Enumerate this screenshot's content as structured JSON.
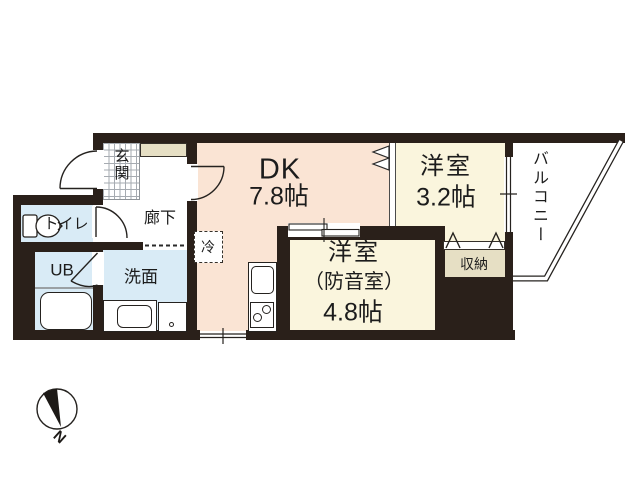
{
  "rooms": {
    "dk": {
      "name": "DK",
      "area": "7.8帖"
    },
    "bedroom": {
      "name": "洋室",
      "area": "3.2帖"
    },
    "soundproof": {
      "name": "洋室",
      "qualifier": "（防音室）",
      "area": "4.8帖"
    },
    "entrance": {
      "label": "玄関"
    },
    "hallway": {
      "label": "廊下"
    },
    "toilet": {
      "label": "トイレ"
    },
    "unit_bath": {
      "label": "UB"
    },
    "washroom": {
      "label": "洗面"
    },
    "storage": {
      "label": "収納"
    },
    "balcony": {
      "label": "バルコニー"
    },
    "refrigerator": {
      "label": "冷"
    }
  },
  "compass": {
    "north_label": "N"
  },
  "colors": {
    "wall": "#2a201a",
    "dk_floor": "#fae4d4",
    "room_floor": "#faf5dd",
    "wet_area_floor": "#d9ebf6",
    "storage_floor": "#e6dfc4",
    "line": "#25221f"
  }
}
